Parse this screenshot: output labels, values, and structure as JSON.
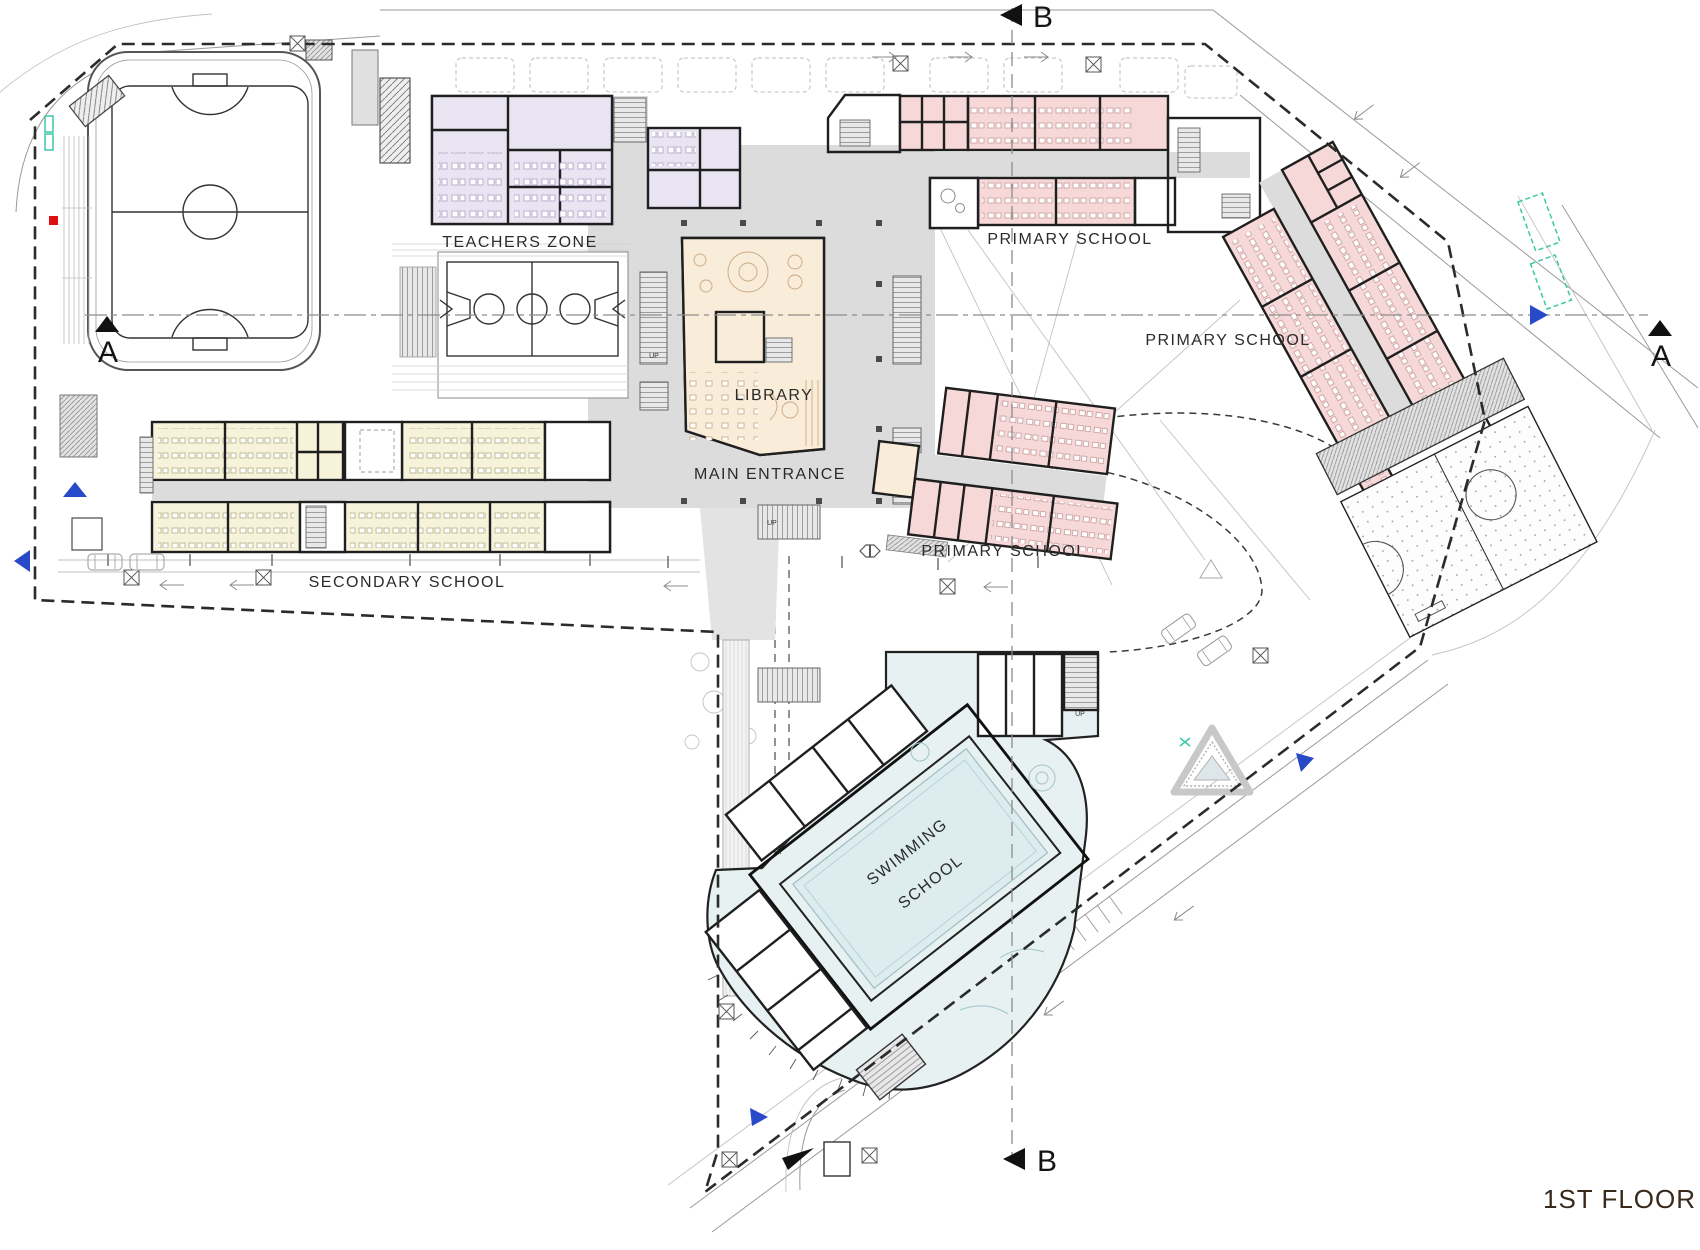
{
  "title": {
    "text": "1ST FLOOR"
  },
  "zones": {
    "teachers_zone": {
      "label": "TEACHERS ZONE",
      "color": "#e9e4f1"
    },
    "primary_school_top": {
      "label": "PRIMARY SCHOOL",
      "color": "#f7d8d8"
    },
    "primary_school_right": {
      "label": "PRIMARY SCHOOL",
      "color": "#f7d8d8"
    },
    "primary_school_mid": {
      "label": "PRIMARY SCHOOL",
      "color": "#f7d8d8"
    },
    "secondary_school": {
      "label": "SECONDARY SCHOOL",
      "color": "#f6f3da"
    },
    "library": {
      "label": "LIBRARY",
      "color": "#f9ecd9"
    },
    "main_entrance": {
      "label": "MAIN ENTRANCE",
      "color": "#dcdcdc"
    },
    "swimming_school": {
      "label_line1": "SWIMMING",
      "label_line2": "SCHOOL",
      "color": "#e7f1f2"
    }
  },
  "section_markers": {
    "a": "A",
    "b": "B"
  },
  "misc": {
    "up_label": "UP"
  },
  "colors": {
    "circulation_gray": "#dcdcdc",
    "wall": "#1f1f1f",
    "primary_pink": "#f7d8d8",
    "secondary_yellow": "#f6f3da",
    "teachers_lavender": "#e9e4f1",
    "library_tan": "#f9ecd9",
    "pool_blue": "#e7f1f2",
    "pool_water": "#ddedef",
    "marker_blue": "#2849c8",
    "alert_red": "#e01010",
    "teal_accent": "#3cc8a8",
    "title_brown": "#38291b"
  }
}
